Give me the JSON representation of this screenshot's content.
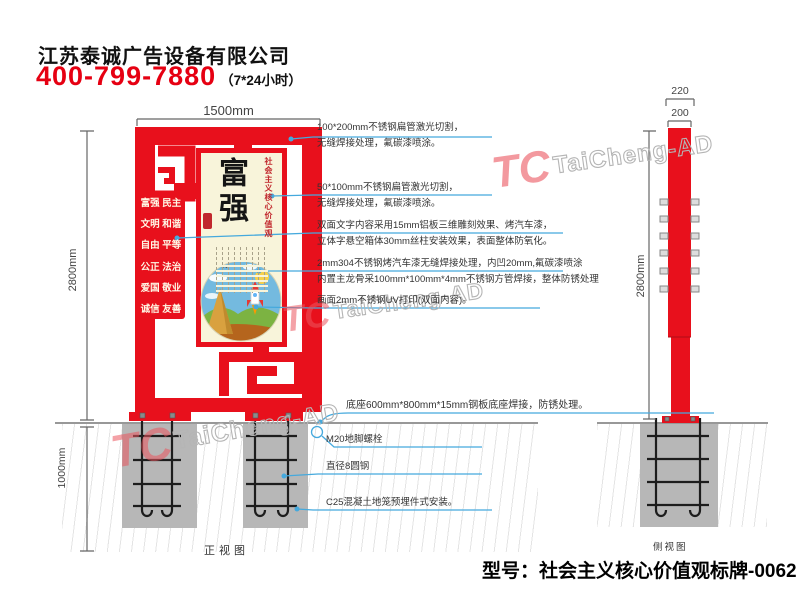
{
  "header": {
    "company": "江苏泰诚广告设备有限公司",
    "phone": "400-799-7880",
    "hours": "（7*24小时）"
  },
  "watermark": {
    "logo": "TC",
    "text": "TaiCheng-AD"
  },
  "front_view": {
    "label": "正视图",
    "dim_width": "1500mm",
    "dim_height": "2800mm",
    "dim_depth": "1000mm",
    "values_rows": [
      "富强 民主",
      "文明 和谐",
      "自由 平等",
      "公正 法治",
      "爱国 敬业",
      "诚信 友善"
    ],
    "poster": {
      "headline": "富强",
      "side_label": "社会主义核心价值观"
    }
  },
  "side_view": {
    "label": "侧视图",
    "dim_outer": "220",
    "dim_inner": "200",
    "dim_height": "2800mm"
  },
  "annotations": {
    "a1": {
      "l1": "100*200mm不锈钢扁管激光切割，",
      "l2": "无缝焊接处理，氟碳漆喷涂。"
    },
    "a2": {
      "l1": "50*100mm不锈钢扁管激光切割，",
      "l2": "无缝焊接处理，氟碳漆喷涂。"
    },
    "a3": {
      "l1": "双面文字内容采用15mm铝板三维雕刻效果、烤汽车漆，",
      "l2": "立体字悬空箱体30mm丝柱安装效果，表面整体防氧化。"
    },
    "a4": {
      "l1": "2mm304不锈钢烤汽车漆无缝焊接处理，内凹20mm,氟碳漆喷涂",
      "l2": "内置主龙骨采100mm*100mm*4mm不锈钢方管焊接，整体防锈处理"
    },
    "a5": {
      "l1": "画面2mm不锈钢UV打印(双面内容)。"
    },
    "a6": {
      "l1": "底座600mm*800mm*15mm钢板底座焊接，防锈处理。"
    },
    "a7": {
      "l1": "M20地脚螺栓"
    },
    "a8": {
      "l1": "直径8圆钢"
    },
    "a9": {
      "l1": "C25混凝土地笼预埋件式安装。"
    }
  },
  "footer": {
    "model": "型号：社会主义核心价值观标牌-0062"
  },
  "colors": {
    "red": "#e8101c",
    "blue": "#45a9dd",
    "cream": "#f8f4da",
    "footing_gray": "#b7b7b7"
  }
}
